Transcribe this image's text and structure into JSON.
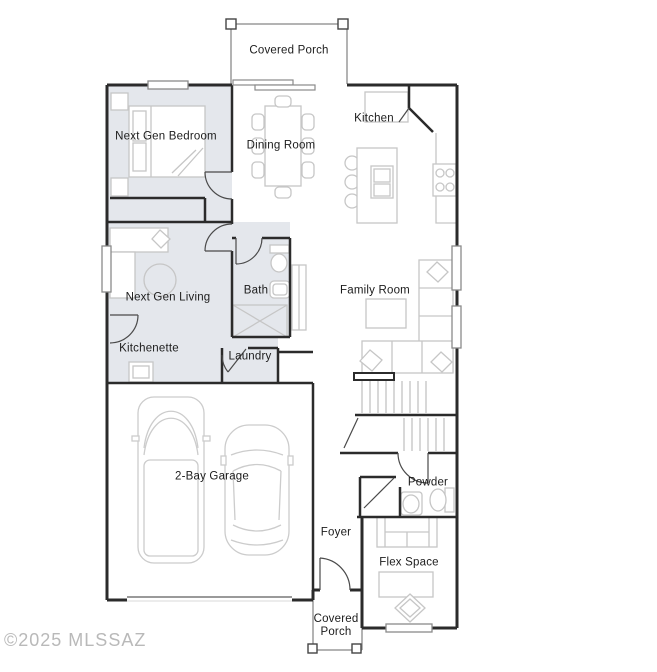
{
  "plan_title": "Single story floor plan",
  "colors": {
    "background": "#ffffff",
    "wall": "#2b2b2b",
    "furniture_outline": "#c6c6c6",
    "shaded_suite_fill": "#e4e7ec",
    "label_text": "#1c1c1c",
    "watermark_text": "#b9b9b9"
  },
  "rooms": {
    "covered_porch_top": {
      "label": "Covered Porch",
      "shaded": false
    },
    "next_gen_bedroom": {
      "label": "Next Gen Bedroom",
      "shaded": true
    },
    "dining_room": {
      "label": "Dining Room",
      "shaded": false
    },
    "kitchen": {
      "label": "Kitchen",
      "shaded": false
    },
    "next_gen_living": {
      "label": "Next Gen Living",
      "shaded": true
    },
    "bath": {
      "label": "Bath",
      "shaded": true
    },
    "family_room": {
      "label": "Family Room",
      "shaded": false
    },
    "kitchenette": {
      "label": "Kitchenette",
      "shaded": true
    },
    "laundry": {
      "label": "Laundry",
      "shaded": true
    },
    "garage": {
      "label": "2-Bay Garage",
      "shaded": false
    },
    "foyer": {
      "label": "Foyer",
      "shaded": false
    },
    "powder": {
      "label": "Powder",
      "shaded": false
    },
    "flex_space": {
      "label": "Flex Space",
      "shaded": false
    },
    "covered_porch_bottom": {
      "label_line1": "Covered",
      "label_line2": "Porch",
      "shaded": false
    }
  },
  "watermark": {
    "text": "©2025 MLSSAZ"
  }
}
